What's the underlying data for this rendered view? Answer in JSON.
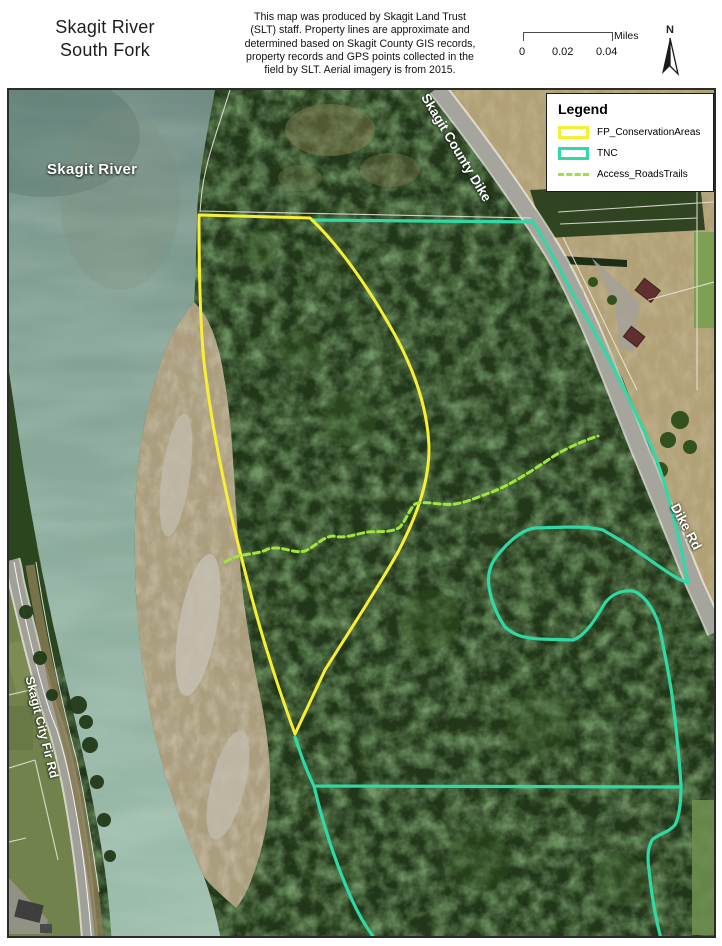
{
  "header": {
    "title_line1": "Skagit River",
    "title_line2": "South Fork",
    "disclaimer_lines": [
      "This map was produced by Skagit Land Trust",
      "(SLT) staff. Property lines are approximate and",
      "determined based on Skagit County GIS records,",
      "property records and GPS points collected in the",
      "field by SLT. Aerial imagery is from 2015."
    ],
    "scale_bar": {
      "tick0": "0",
      "tick1": "0.02",
      "tick2": "0.04",
      "unit": "Miles"
    },
    "north_label": "N"
  },
  "legend": {
    "title": "Legend",
    "items": [
      {
        "label": "FP_ConservationAreas",
        "swatch": "rect-outline",
        "color": "#f7ef35"
      },
      {
        "label": "TNC",
        "swatch": "rect-outline",
        "color": "#2fd9a6"
      },
      {
        "label": "Access_RoadsTrails",
        "swatch": "dashed-line",
        "color": "#9de23c"
      }
    ]
  },
  "map": {
    "labels": [
      {
        "text": "Skagit River"
      },
      {
        "text": "Skagit County Dike"
      },
      {
        "text": "Dike Rd"
      },
      {
        "text": "Skagit City Fir Rd"
      }
    ]
  },
  "colors": {
    "fp_conservation": "#f7ef35",
    "tnc": "#2fd9a6",
    "access_trail": "#a0e53c",
    "water_top": "#708c84",
    "water_bottom": "#9fbfae",
    "forest": "#223619",
    "sand": "#ab9e7e",
    "field_tan": "#b2a176",
    "road_gray": "#a6a59d"
  }
}
